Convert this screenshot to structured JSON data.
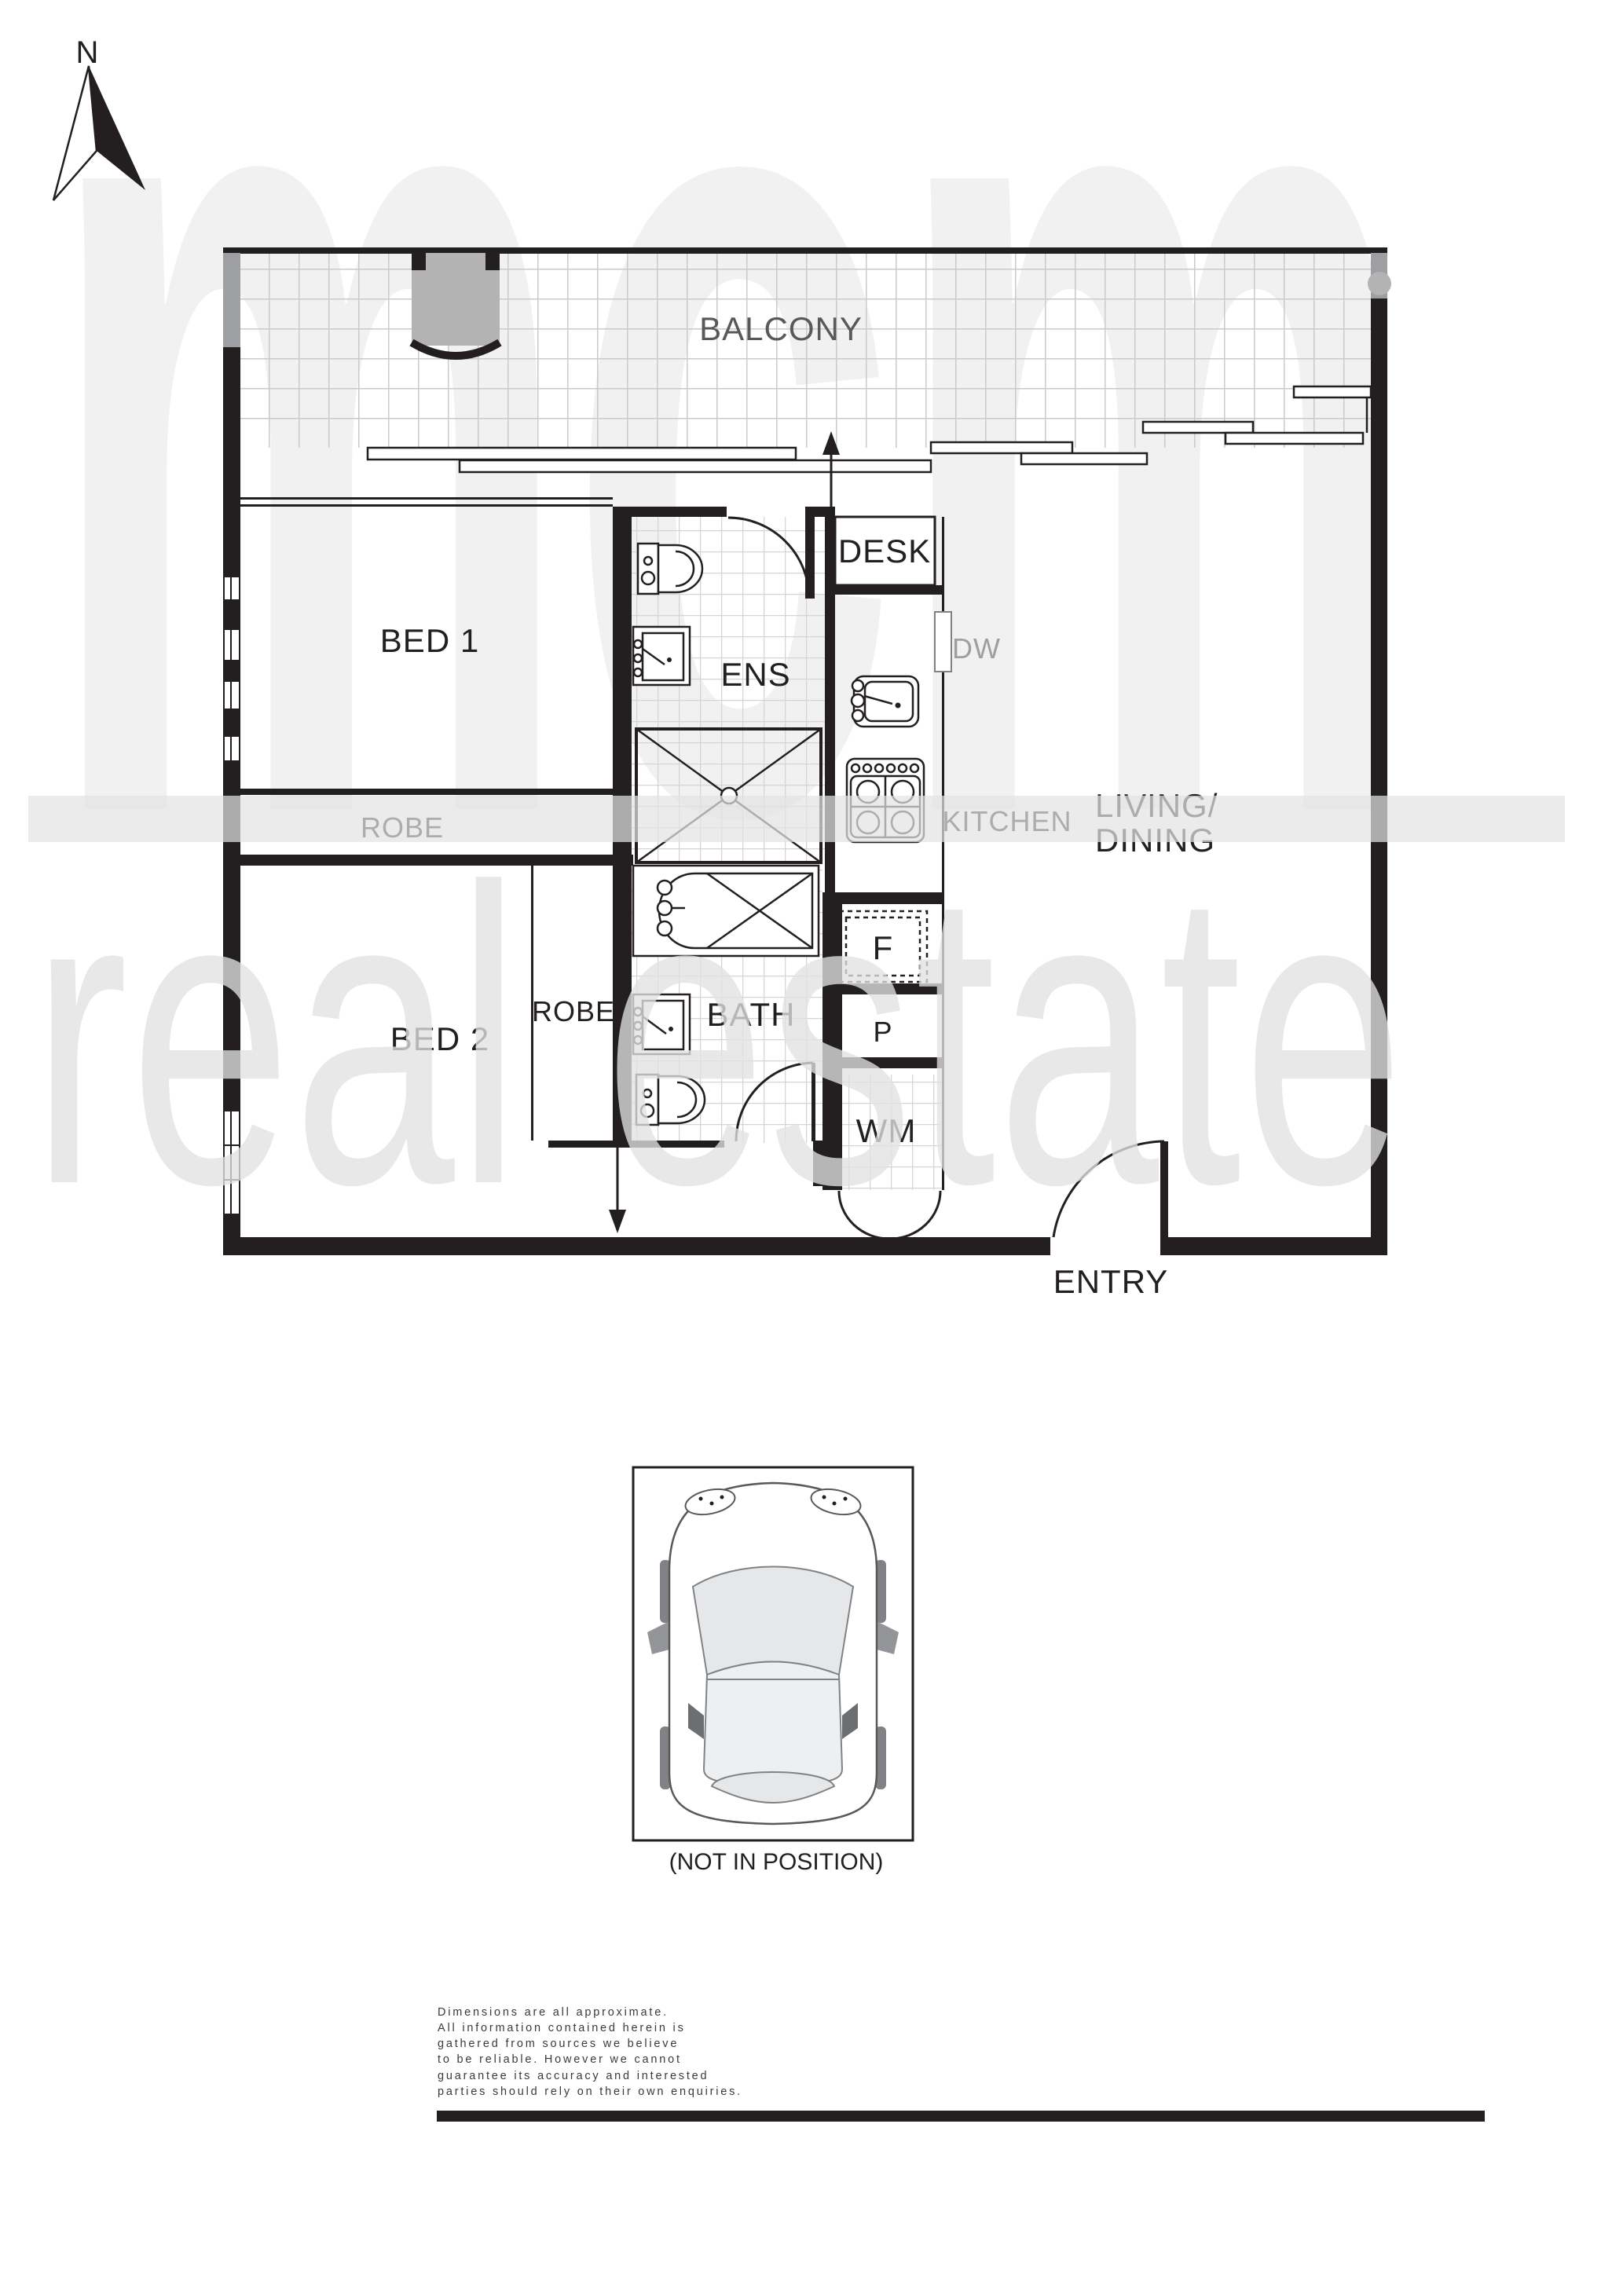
{
  "compass": {
    "north_label": "N"
  },
  "watermark": {
    "top": "mcm",
    "bottom": "real estate"
  },
  "rooms": {
    "balcony": "BALCONY",
    "bed1": "BED 1",
    "ens": "ENS",
    "desk": "DESK",
    "robe1": "ROBE",
    "kitchen": "KITCHEN",
    "living_line1": "LIVING/",
    "living_line2": "DINING",
    "bed2": "BED 2",
    "robe2": "ROBE",
    "bath": "BATH",
    "entry": "ENTRY"
  },
  "appliances": {
    "dishwasher": "DW",
    "fridge": "F",
    "pantry": "P",
    "washing_machine": "WM"
  },
  "parking": {
    "caption": "(NOT IN POSITION)"
  },
  "disclaimer": {
    "lines": [
      "Dimensions are all approximate.",
      "All information contained herein is",
      "gathered from sources we believe",
      "to be reliable. However we cannot",
      "guarantee its accuracy and interested",
      "parties should rely on their own enquiries."
    ]
  },
  "colors": {
    "wall": "#231f20",
    "gray_label": "#9d9fa2",
    "tile_line": "#d0d1d3",
    "watermark": "#f1f1f1",
    "column_gray": "#b3b3b3"
  }
}
